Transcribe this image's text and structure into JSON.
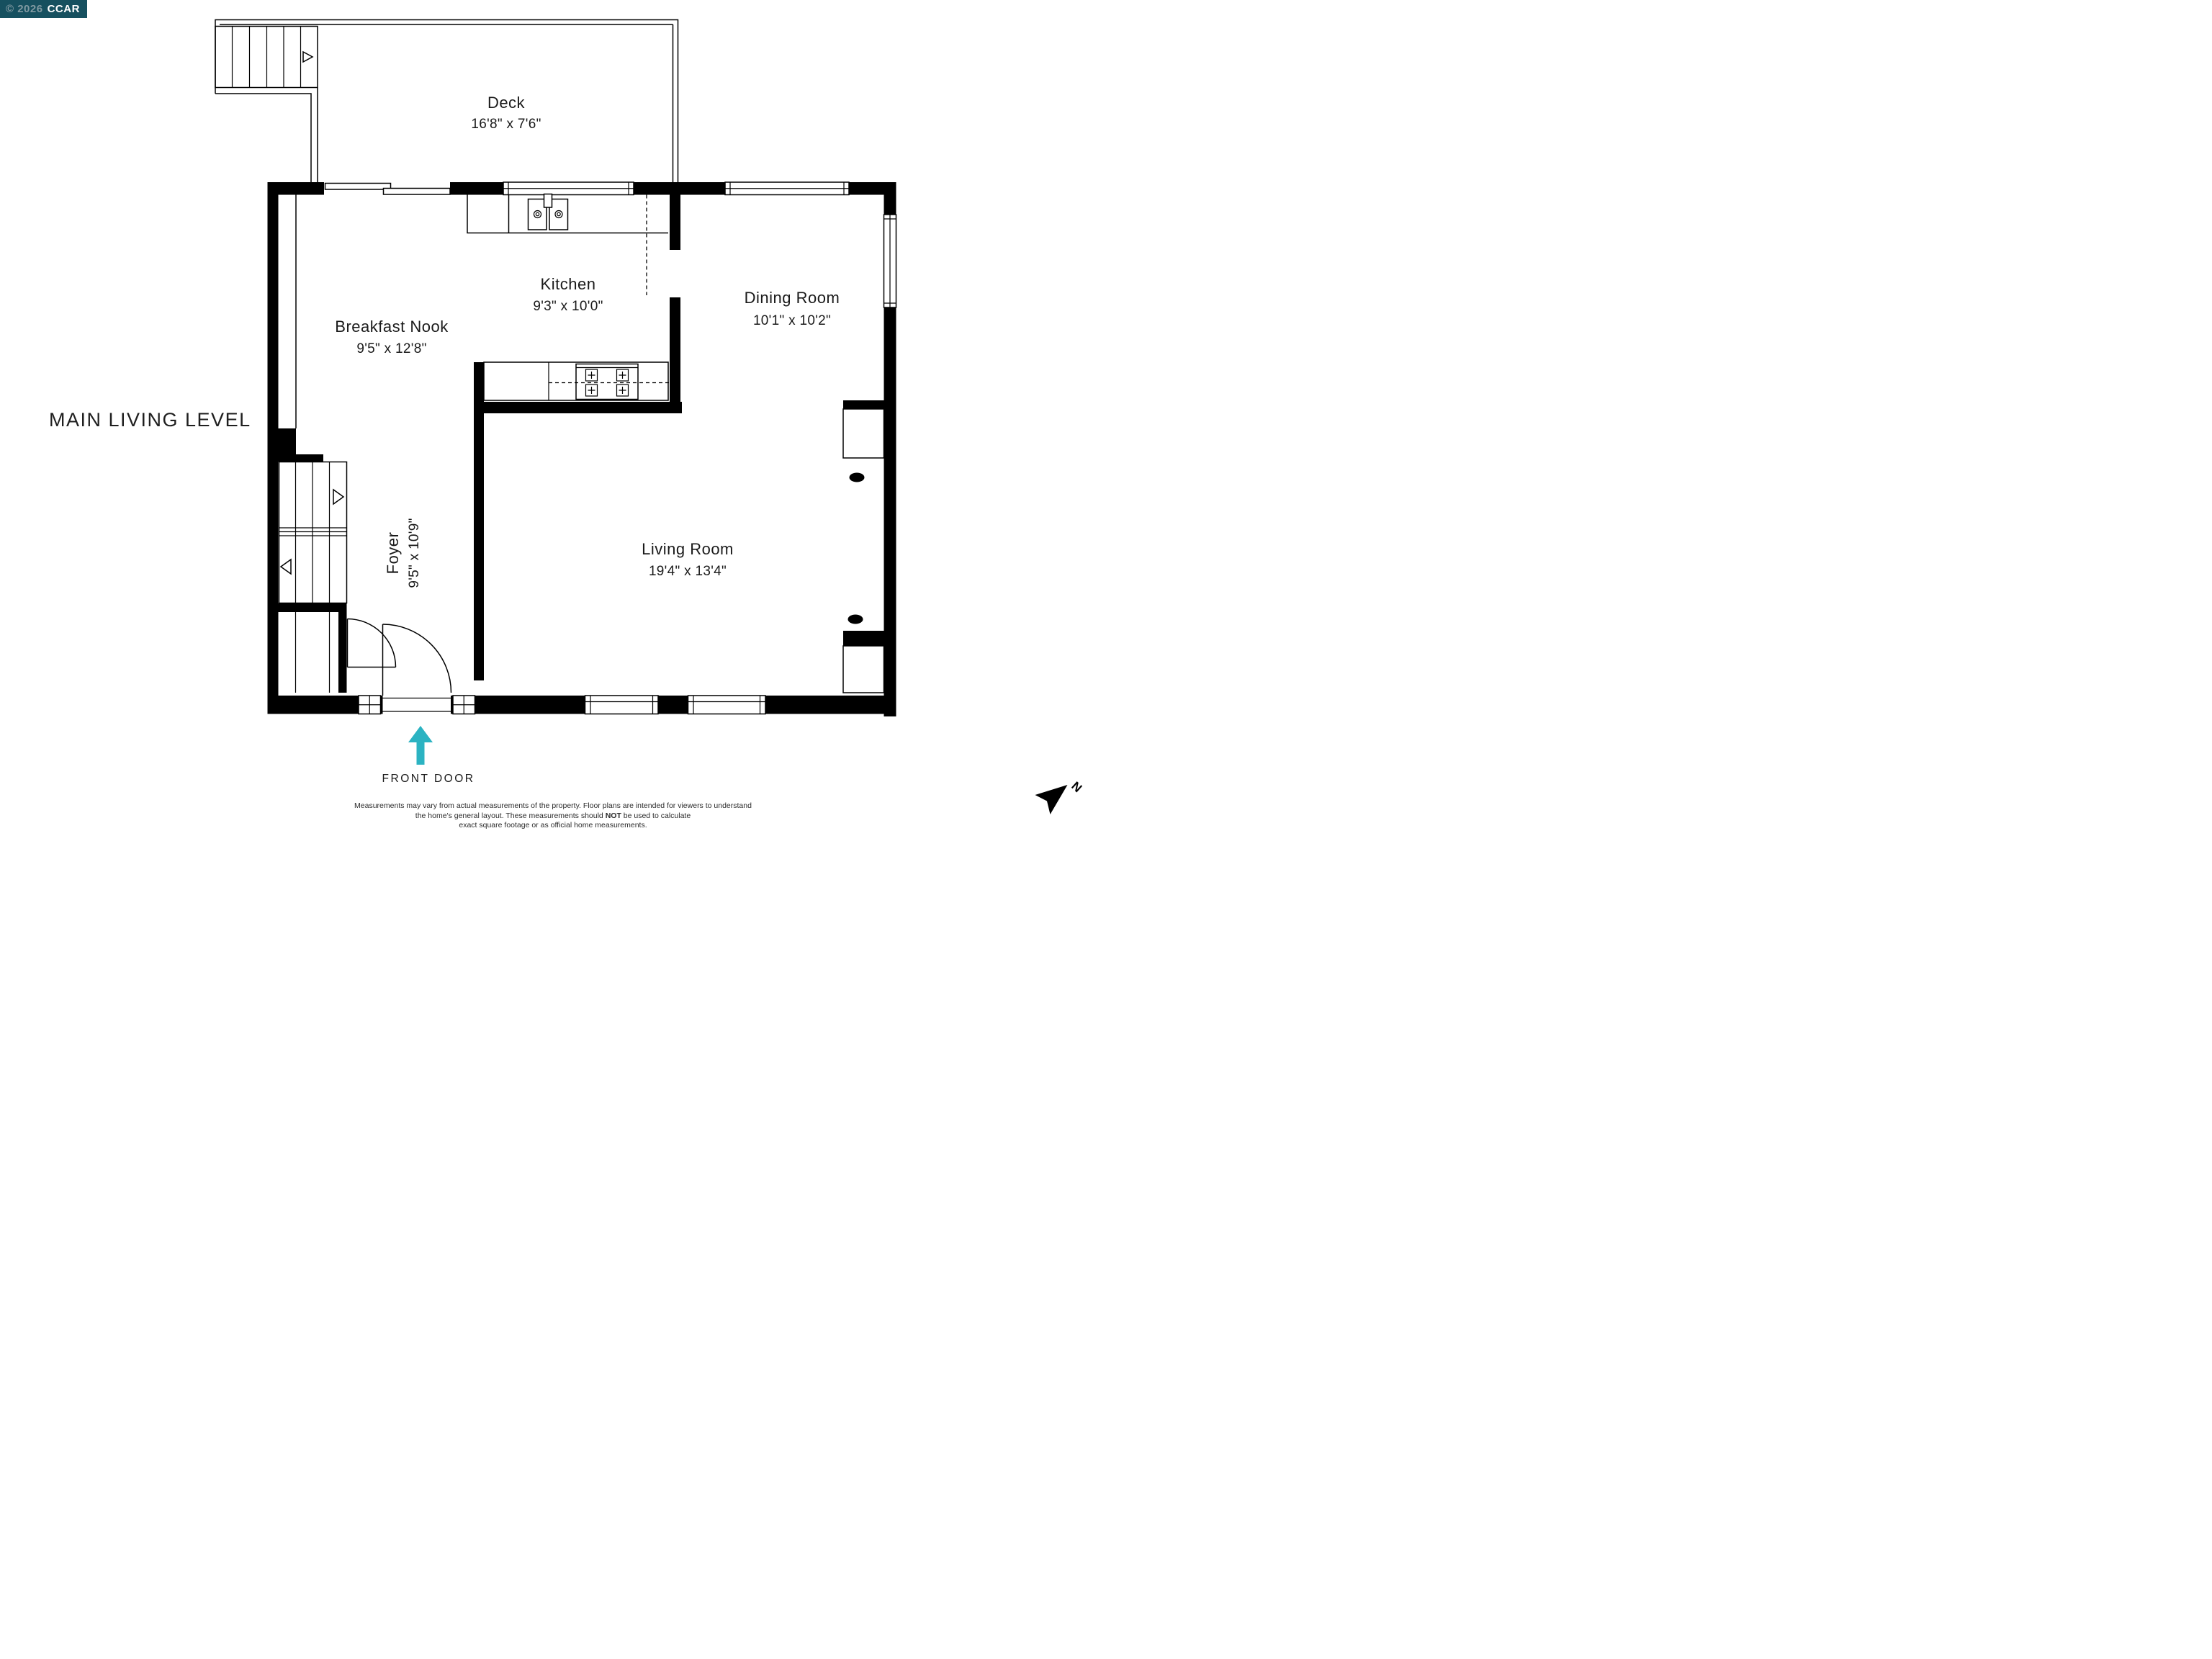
{
  "badge": {
    "copyright": "© 2026",
    "brand": "CCAR",
    "bg_color": "#16505F",
    "copyright_color": "#A9B6BB",
    "brand_color": "#FFFFFF"
  },
  "plan_title": "MAIN LIVING LEVEL",
  "rooms": {
    "deck": {
      "name": "Deck",
      "dims": "16'8\" x 7'6\""
    },
    "kitchen": {
      "name": "Kitchen",
      "dims": "9'3\" x 10'0\""
    },
    "nook": {
      "name": "Breakfast Nook",
      "dims": "9'5\" x 12'8\""
    },
    "dining": {
      "name": "Dining Room",
      "dims": "10'1\" x 10'2\""
    },
    "living": {
      "name": "Living Room",
      "dims": "19'4\" x 13'4\""
    },
    "foyer": {
      "name": "Foyer",
      "dims": "9'5\" x 10'9\""
    }
  },
  "front_door": {
    "label": "FRONT DOOR",
    "arrow_color": "#2BB3C2"
  },
  "north_arrow": {
    "label": "N"
  },
  "disclaimer": {
    "line1": "Measurements may vary from actual measurements of the property. Floor plans are intended for viewers to understand",
    "line2_pre": "the home's general layout.  These measurements should ",
    "line2_bold": "NOT",
    "line2_post": " be used to calculate",
    "line3": "exact square footage or as official home measurements."
  },
  "line_color": "#000000",
  "text_color": "#1a1a1a"
}
